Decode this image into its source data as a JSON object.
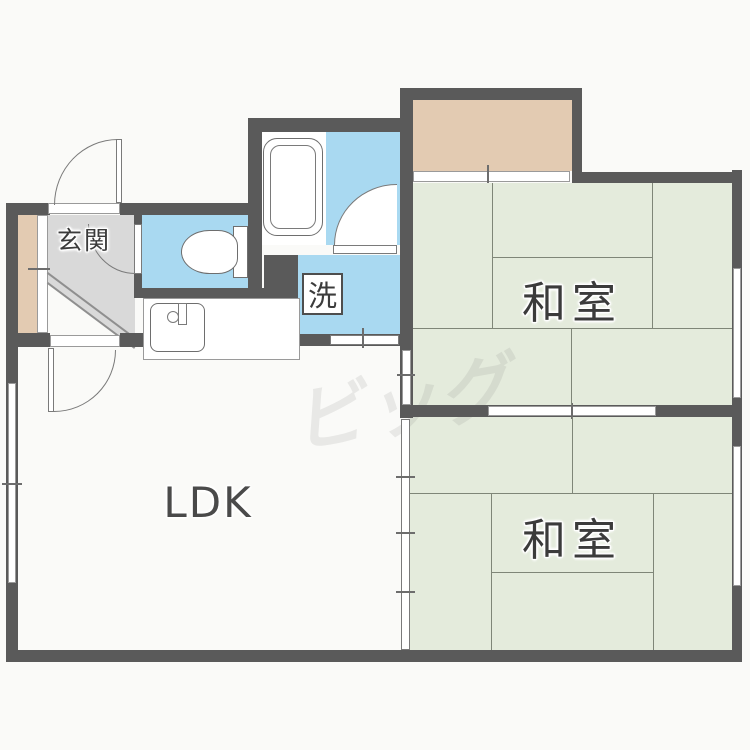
{
  "meta": {
    "type": "japanese-apartment-floor-plan"
  },
  "labels": {
    "entrance": "玄関",
    "washer": "洗",
    "japanese_room_north": "和室",
    "japanese_room_south": "和室",
    "ldk": "LDK",
    "watermark": "ビッグ"
  },
  "rooms": [
    {
      "id": "ldk",
      "label": "LDK"
    },
    {
      "id": "japanese-room-north",
      "label": "和室",
      "tatami_mats": 6
    },
    {
      "id": "japanese-room-south",
      "label": "和室",
      "tatami_mats": 6
    },
    {
      "id": "entrance-genkan",
      "label": "玄関"
    },
    {
      "id": "washer-area",
      "label": "洗"
    }
  ],
  "fixtures": [
    "bathtub",
    "toilet",
    "kitchen-sink",
    "washing-machine-pan",
    "balcony",
    "shoe-cabinet"
  ],
  "colors": {
    "bg": "#fafaf8",
    "wall": "#5a5a5a",
    "tatami": "#e4ebdc",
    "water": "#a9d9f1",
    "balcony": "#e3cbb2",
    "genkan": "#d9d9d9",
    "line": "#7f8678",
    "label": "#3b3b3b"
  }
}
